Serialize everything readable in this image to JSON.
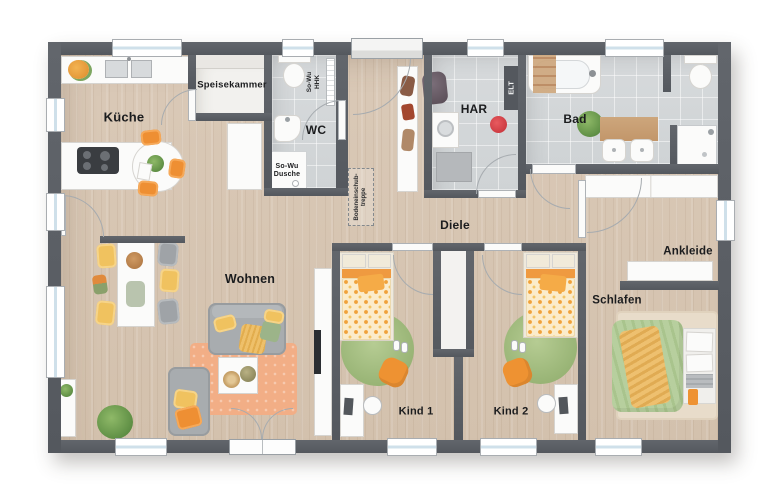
{
  "floorplan": {
    "labels": {
      "kueche": "Küche",
      "speisekammer": "Speisekammer",
      "wc": "WC",
      "so_wu_hhk": "So-Wu\nHHK",
      "so_wu_dusche": "So-Wu\nDusche",
      "har": "HAR",
      "elt": "ELT",
      "bad": "Bad",
      "diele": "Diele",
      "bodeneinschubtreppe": "Bodeneinschub-\ntreppe",
      "wohnen": "Wohnen",
      "kind1": "Kind 1",
      "kind2": "Kind 2",
      "schlafen": "Schlafen",
      "ankleide": "Ankleide"
    },
    "colors": {
      "wall": "#595d63",
      "wood_floor": "#d8c7b4",
      "tile_floor": "#d4d7d9",
      "pantry_floor": "#f2f1ee",
      "accent_orange": "#ee8f33",
      "accent_yellow": "#f0c25f",
      "accent_green": "#9cb779",
      "rug_salmon": "#f2ae86",
      "bed_green": "#aec98f",
      "window_glass": "#cfe0ea"
    }
  }
}
